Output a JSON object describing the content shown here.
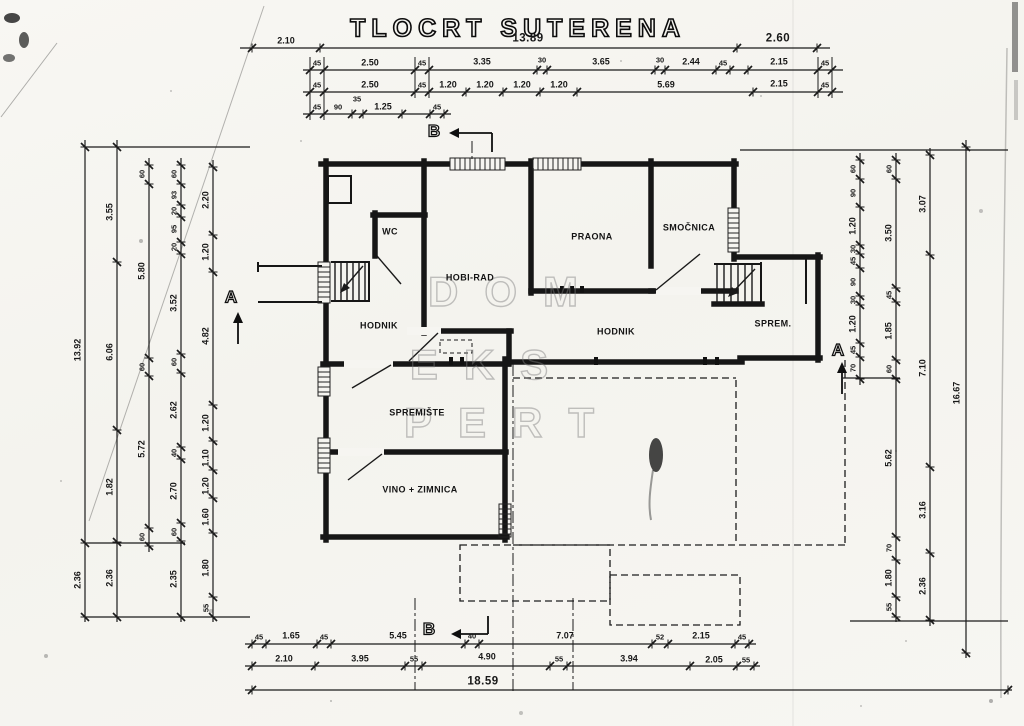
{
  "title": "TLOCRT SUTERENA",
  "watermark": [
    {
      "t": "DOM",
      "x": 516,
      "y": 292
    },
    {
      "t": "EKS",
      "x": 492,
      "y": 365
    },
    {
      "t": "PERT",
      "x": 512,
      "y": 423
    }
  ],
  "rooms": [
    {
      "t": "WC",
      "x": 390,
      "y": 232
    },
    {
      "t": "HOBI-RAD",
      "x": 470,
      "y": 278
    },
    {
      "t": "PRAONA",
      "x": 592,
      "y": 237
    },
    {
      "t": "SMOČNICA",
      "x": 689,
      "y": 228
    },
    {
      "t": "HODNIK",
      "x": 379,
      "y": 326
    },
    {
      "t": "HODNIK",
      "x": 616,
      "y": 332
    },
    {
      "t": "SPREM.",
      "x": 773,
      "y": 324
    },
    {
      "t": "SPREMIŠTE",
      "x": 417,
      "y": 413
    },
    {
      "t": "VINO + ZIMNICA",
      "x": 420,
      "y": 490
    }
  ],
  "sections": [
    {
      "t": "A",
      "x": 231,
      "y": 297
    },
    {
      "t": "A",
      "x": 838,
      "y": 350
    },
    {
      "t": "B",
      "x": 434,
      "y": 131
    },
    {
      "t": "B",
      "x": 429,
      "y": 629
    }
  ],
  "dims": {
    "top": [
      {
        "t": "2.10",
        "x": 286,
        "y": 41
      },
      {
        "t": "13.89",
        "x": 528,
        "y": 39,
        "cls": "b"
      },
      {
        "t": "2.60",
        "x": 778,
        "y": 39,
        "cls": "b"
      },
      {
        "t": "45",
        "x": 317,
        "y": 63,
        "cls": "s"
      },
      {
        "t": "2.50",
        "x": 370,
        "y": 63
      },
      {
        "t": "45",
        "x": 422,
        "y": 63,
        "cls": "s"
      },
      {
        "t": "3.35",
        "x": 482,
        "y": 62
      },
      {
        "t": "30",
        "x": 542,
        "y": 60,
        "cls": "s"
      },
      {
        "t": "3.65",
        "x": 601,
        "y": 62
      },
      {
        "t": "30",
        "x": 660,
        "y": 60,
        "cls": "s"
      },
      {
        "t": "2.44",
        "x": 691,
        "y": 62
      },
      {
        "t": "45",
        "x": 723,
        "y": 63,
        "cls": "s"
      },
      {
        "t": "2.15",
        "x": 779,
        "y": 62
      },
      {
        "t": "45",
        "x": 825,
        "y": 63,
        "cls": "s"
      },
      {
        "t": "45",
        "x": 317,
        "y": 85,
        "cls": "s"
      },
      {
        "t": "2.50",
        "x": 370,
        "y": 85
      },
      {
        "t": "45",
        "x": 422,
        "y": 85,
        "cls": "s"
      },
      {
        "t": "1.20",
        "x": 448,
        "y": 85
      },
      {
        "t": "1.20",
        "x": 485,
        "y": 85
      },
      {
        "t": "1.20",
        "x": 522,
        "y": 85
      },
      {
        "t": "1.20",
        "x": 559,
        "y": 85
      },
      {
        "t": "5.69",
        "x": 666,
        "y": 85
      },
      {
        "t": "2.15",
        "x": 779,
        "y": 84
      },
      {
        "t": "45",
        "x": 825,
        "y": 85,
        "cls": "s"
      },
      {
        "t": "45",
        "x": 317,
        "y": 107,
        "cls": "s"
      },
      {
        "t": "90",
        "x": 338,
        "y": 107,
        "cls": "s"
      },
      {
        "t": "35",
        "x": 357,
        "y": 99,
        "cls": "s"
      },
      {
        "t": "1.25",
        "x": 383,
        "y": 107
      },
      {
        "t": "45",
        "x": 437,
        "y": 107,
        "cls": "s"
      }
    ],
    "bottom": [
      {
        "t": "45",
        "x": 259,
        "y": 637,
        "cls": "s"
      },
      {
        "t": "1.65",
        "x": 291,
        "y": 636
      },
      {
        "t": "45",
        "x": 324,
        "y": 637,
        "cls": "s"
      },
      {
        "t": "5.45",
        "x": 398,
        "y": 636
      },
      {
        "t": "40",
        "x": 472,
        "y": 636,
        "cls": "s"
      },
      {
        "t": "7.07",
        "x": 565,
        "y": 636
      },
      {
        "t": "52",
        "x": 660,
        "y": 637,
        "cls": "s"
      },
      {
        "t": "2.15",
        "x": 701,
        "y": 636
      },
      {
        "t": "45",
        "x": 742,
        "y": 637,
        "cls": "s"
      },
      {
        "t": "2.10",
        "x": 284,
        "y": 659
      },
      {
        "t": "3.95",
        "x": 360,
        "y": 659
      },
      {
        "t": "55",
        "x": 414,
        "y": 659,
        "cls": "s"
      },
      {
        "t": "4.90",
        "x": 487,
        "y": 657
      },
      {
        "t": "55",
        "x": 559,
        "y": 659,
        "cls": "s"
      },
      {
        "t": "3.94",
        "x": 629,
        "y": 659
      },
      {
        "t": "2.05",
        "x": 714,
        "y": 660
      },
      {
        "t": "55",
        "x": 746,
        "y": 660,
        "cls": "s"
      },
      {
        "t": "18.59",
        "x": 483,
        "y": 682,
        "cls": "b"
      }
    ],
    "left": [
      {
        "t": "13.92",
        "x": 78,
        "y": 350
      },
      {
        "t": "2.36",
        "x": 78,
        "y": 580
      },
      {
        "t": "3.55",
        "x": 110,
        "y": 212
      },
      {
        "t": "6.06",
        "x": 110,
        "y": 352
      },
      {
        "t": "1.82",
        "x": 110,
        "y": 487
      },
      {
        "t": "2.36",
        "x": 110,
        "y": 578
      },
      {
        "t": "60",
        "x": 142,
        "y": 174,
        "cls": "s"
      },
      {
        "t": "5.80",
        "x": 142,
        "y": 271
      },
      {
        "t": "60",
        "x": 142,
        "y": 367,
        "cls": "s"
      },
      {
        "t": "5.72",
        "x": 142,
        "y": 449
      },
      {
        "t": "60",
        "x": 142,
        "y": 537,
        "cls": "s"
      },
      {
        "t": "60",
        "x": 174,
        "y": 174,
        "cls": "s"
      },
      {
        "t": "93",
        "x": 174,
        "y": 195,
        "cls": "s"
      },
      {
        "t": "20",
        "x": 174,
        "y": 211,
        "cls": "s"
      },
      {
        "t": "95",
        "x": 174,
        "y": 229,
        "cls": "s"
      },
      {
        "t": "20",
        "x": 174,
        "y": 247,
        "cls": "s"
      },
      {
        "t": "3.52",
        "x": 174,
        "y": 303
      },
      {
        "t": "60",
        "x": 174,
        "y": 362,
        "cls": "s"
      },
      {
        "t": "2.62",
        "x": 174,
        "y": 410
      },
      {
        "t": "40",
        "x": 174,
        "y": 453,
        "cls": "s"
      },
      {
        "t": "2.70",
        "x": 174,
        "y": 491
      },
      {
        "t": "60",
        "x": 174,
        "y": 532,
        "cls": "s"
      },
      {
        "t": "2.35",
        "x": 174,
        "y": 579
      },
      {
        "t": "2.20",
        "x": 206,
        "y": 200
      },
      {
        "t": "1.20",
        "x": 206,
        "y": 252
      },
      {
        "t": "4.82",
        "x": 206,
        "y": 336
      },
      {
        "t": "1.20",
        "x": 206,
        "y": 423
      },
      {
        "t": "1.10",
        "x": 206,
        "y": 458
      },
      {
        "t": "1.20",
        "x": 206,
        "y": 486
      },
      {
        "t": "1.60",
        "x": 206,
        "y": 517
      },
      {
        "t": "1.80",
        "x": 206,
        "y": 568
      },
      {
        "t": "55",
        "x": 206,
        "y": 608,
        "cls": "s"
      }
    ],
    "right": [
      {
        "t": "60",
        "x": 853,
        "y": 169,
        "cls": "s"
      },
      {
        "t": "90",
        "x": 853,
        "y": 193,
        "cls": "s"
      },
      {
        "t": "1.20",
        "x": 853,
        "y": 226
      },
      {
        "t": "30",
        "x": 853,
        "y": 249,
        "cls": "s"
      },
      {
        "t": "45",
        "x": 853,
        "y": 261,
        "cls": "s"
      },
      {
        "t": "90",
        "x": 853,
        "y": 282,
        "cls": "s"
      },
      {
        "t": "30",
        "x": 853,
        "y": 300,
        "cls": "s"
      },
      {
        "t": "1.20",
        "x": 853,
        "y": 324
      },
      {
        "t": "45",
        "x": 853,
        "y": 350,
        "cls": "s"
      },
      {
        "t": "70",
        "x": 853,
        "y": 368,
        "cls": "s"
      },
      {
        "t": "60",
        "x": 889,
        "y": 169,
        "cls": "s"
      },
      {
        "t": "3.50",
        "x": 889,
        "y": 233
      },
      {
        "t": "45",
        "x": 889,
        "y": 295,
        "cls": "s"
      },
      {
        "t": "1.85",
        "x": 889,
        "y": 331
      },
      {
        "t": "60",
        "x": 889,
        "y": 369,
        "cls": "s"
      },
      {
        "t": "5.62",
        "x": 889,
        "y": 458
      },
      {
        "t": "70",
        "x": 889,
        "y": 548,
        "cls": "s"
      },
      {
        "t": "1.80",
        "x": 889,
        "y": 578
      },
      {
        "t": "55",
        "x": 889,
        "y": 607,
        "cls": "s"
      },
      {
        "t": "3.07",
        "x": 923,
        "y": 204
      },
      {
        "t": "7.10",
        "x": 923,
        "y": 368
      },
      {
        "t": "3.16",
        "x": 923,
        "y": 510
      },
      {
        "t": "2.36",
        "x": 923,
        "y": 586
      },
      {
        "t": "16.67",
        "x": 957,
        "y": 393
      }
    ]
  }
}
